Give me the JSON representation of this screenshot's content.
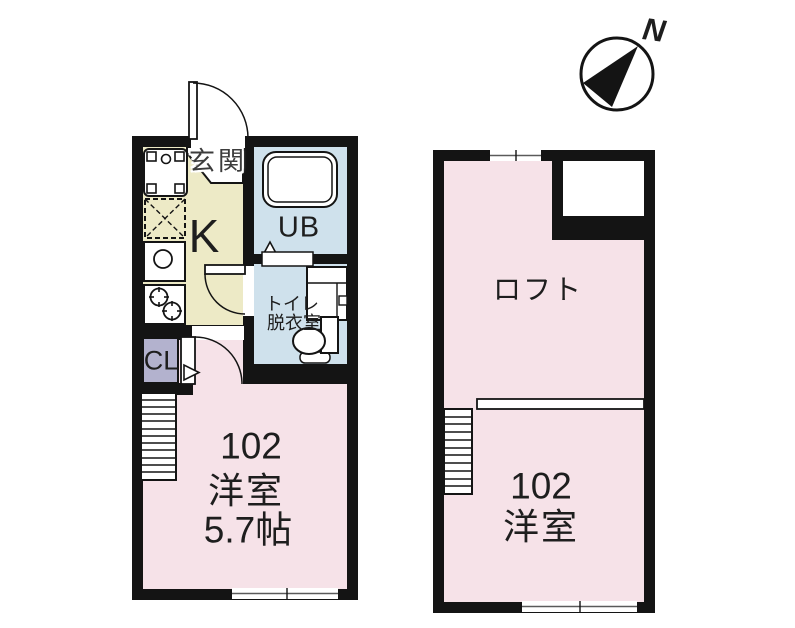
{
  "compass": {
    "north_label": "N"
  },
  "floor1": {
    "entrance_label": "玄関",
    "kitchen_label": "K",
    "unit_bath_label": "UB",
    "toilet_label": "トイレ",
    "dressing_room_label": "脱衣室",
    "closet_label": "CL",
    "room_number": "102",
    "room_name": "洋室",
    "room_size": "5.7帖"
  },
  "floor2": {
    "loft_label": "ロフト",
    "room_number": "102",
    "room_name": "洋室"
  },
  "colors": {
    "wall_black": "#141414",
    "room_pink": "#f6e2e8",
    "kitchen_yellow": "#edeac6",
    "bath_blue": "#cfe1ec",
    "closet_lavender": "#b3b2ce",
    "background": "#ffffff"
  }
}
